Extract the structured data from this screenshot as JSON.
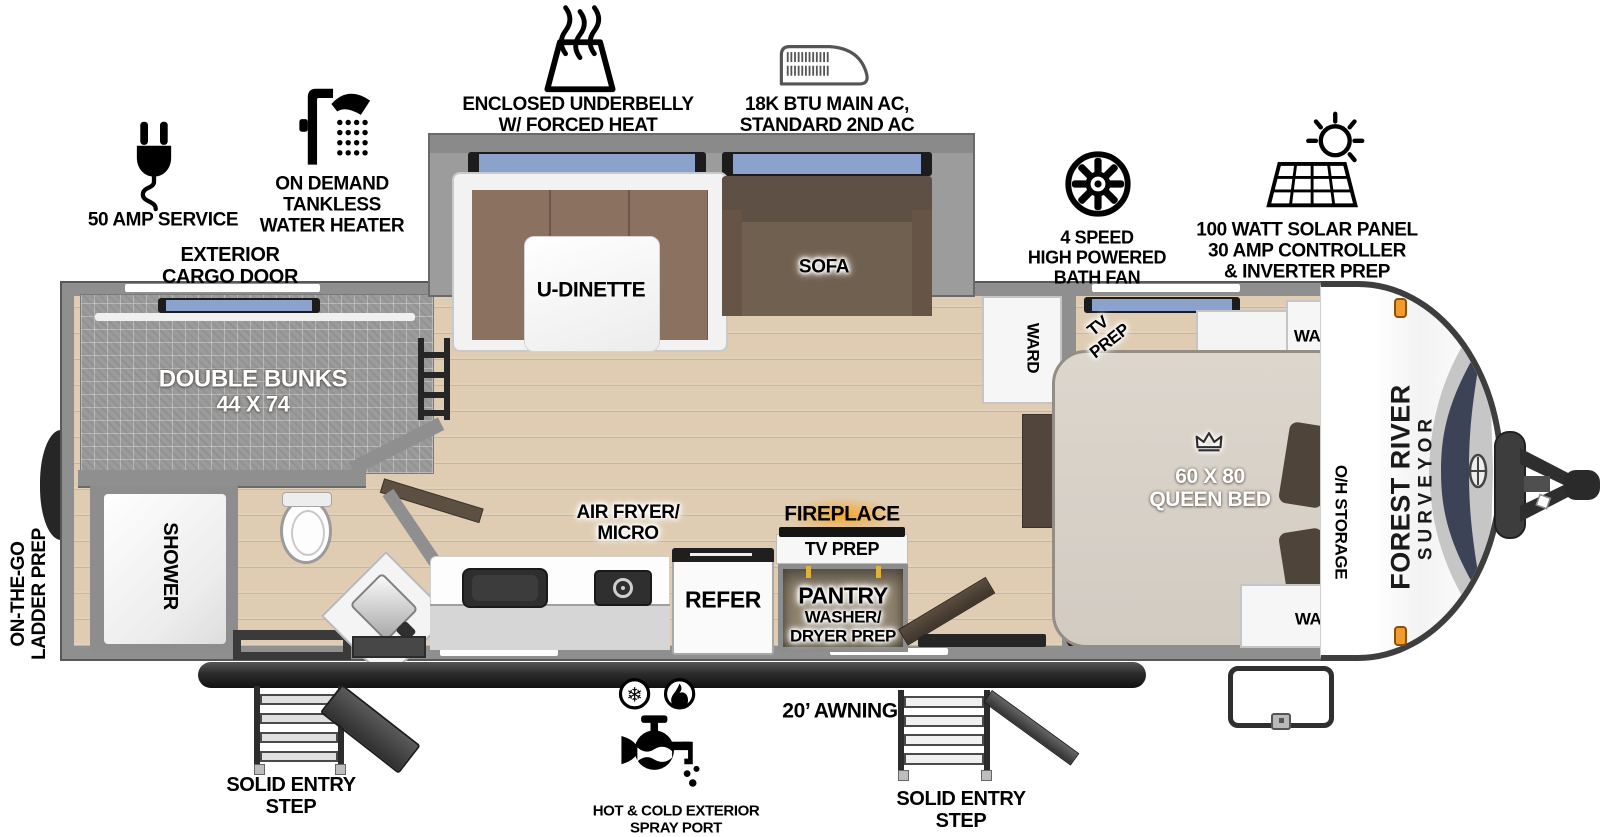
{
  "colors": {
    "wall_gray": "#8f8f8f",
    "floor_tan": "#dfccb2",
    "bunk_mat_gray": "#9b9b9b",
    "window_blue": "#8ba2cd",
    "sofa_brown": "#70604f",
    "cushion_brown": "#8a7160",
    "bed_beige": "#dad3ca",
    "pillow_brown": "#4e443a",
    "fireplace_orange": "#f7a521",
    "marker_orange": "#ef9b2d",
    "awning_dark": "#2a2a2a",
    "label_black": "#000000"
  },
  "callouts": {
    "amp": {
      "icon": "power-plug-icon",
      "label": "50 AMP SERVICE"
    },
    "water_heater": {
      "icon": "shower-head-icon",
      "lines": [
        "ON DEMAND",
        "TANKLESS",
        "WATER HEATER"
      ]
    },
    "cargo_door": {
      "lines": [
        "EXTERIOR",
        "CARGO DOOR"
      ]
    },
    "underbelly": {
      "icon": "heated-underbelly-icon",
      "lines": [
        "ENCLOSED UNDERBELLY",
        "W/ FORCED HEAT"
      ]
    },
    "ac": {
      "icon": "air-conditioner-icon",
      "lines": [
        "18K BTU MAIN AC,",
        "STANDARD 2ND AC"
      ]
    },
    "bath_fan": {
      "icon": "fan-icon",
      "lines": [
        "4 SPEED",
        "HIGH POWERED",
        "BATH FAN"
      ]
    },
    "solar": {
      "icon": "solar-panel-icon",
      "lines": [
        "100 WATT SOLAR PANEL",
        "30 AMP CONTROLLER",
        "& INVERTER PREP"
      ]
    },
    "ladder": {
      "lines": [
        "ON-THE-GO",
        "LADDER PREP"
      ]
    },
    "spray_port": {
      "icon": "spray-port-icon",
      "lines": [
        "HOT & COLD EXTERIOR",
        "SPRAY PORT"
      ]
    },
    "awning": {
      "label": "20’ AWNING"
    },
    "entry_step_left": {
      "lines": [
        "SOLID ENTRY",
        "STEP"
      ]
    },
    "entry_step_right": {
      "lines": [
        "SOLID ENTRY",
        "STEP"
      ]
    }
  },
  "interior": {
    "bunks": {
      "lines": [
        "DOUBLE BUNKS",
        "44 X 74"
      ]
    },
    "shower": {
      "label": "SHOWER"
    },
    "dinette": {
      "label": "U-DINETTE"
    },
    "sofa": {
      "label": "SOFA"
    },
    "ward_hall": {
      "label": "WARD"
    },
    "tv_prep_bedroom": {
      "lines": [
        "TV",
        "PREP"
      ]
    },
    "ward_front": {
      "label": "WARD"
    },
    "ward_foot": {
      "label": "WARD"
    },
    "queen_bed": {
      "lines": [
        "60 X 80",
        "QUEEN BED"
      ],
      "icon": "crown-icon"
    },
    "oh_storage": {
      "label": "O/H STORAGE"
    },
    "air_fryer": {
      "lines": [
        "AIR FRYER/",
        "MICRO"
      ]
    },
    "refer": {
      "label": "REFER"
    },
    "fireplace": {
      "label": "FIREPLACE"
    },
    "tv_prep_kitchen": {
      "label": "TV PREP"
    },
    "pantry": {
      "lines": [
        "PANTRY",
        "WASHER/",
        "DRYER PREP"
      ]
    }
  },
  "branding": {
    "make": "FOREST RIVER",
    "model": "SURVEYOR"
  }
}
